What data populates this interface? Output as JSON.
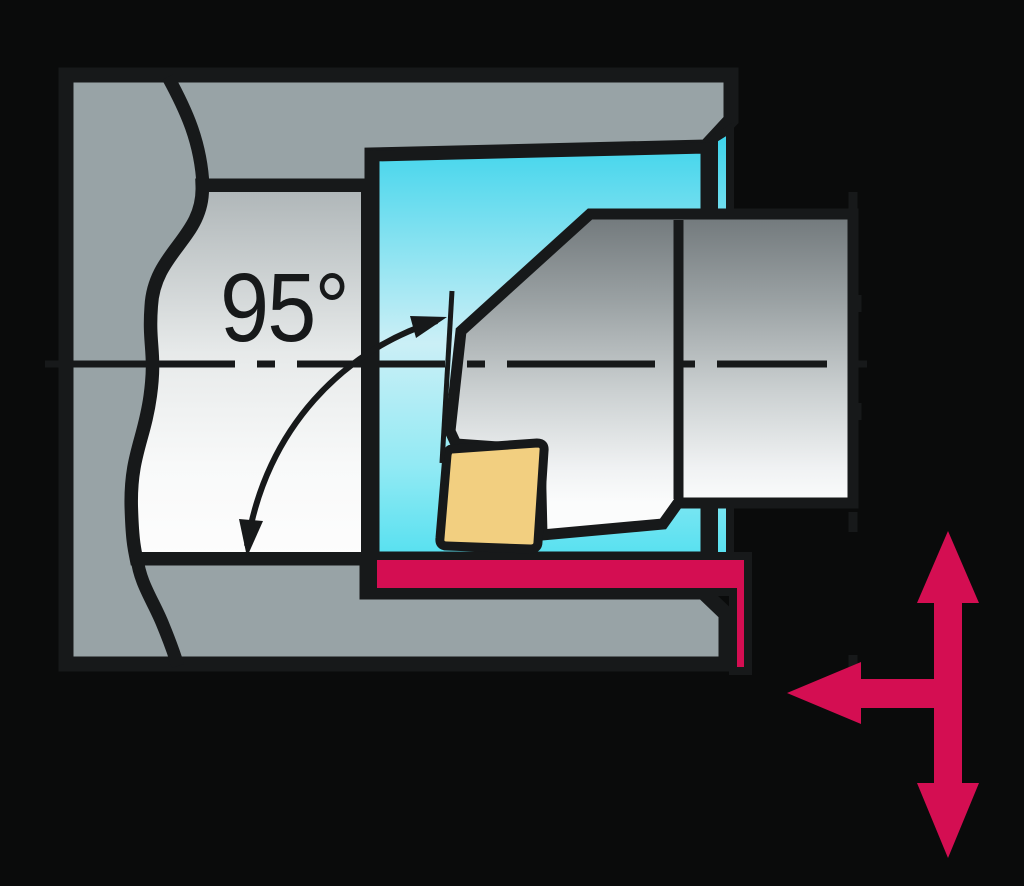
{
  "figure": {
    "type": "technical-diagram",
    "subject": "internal boring tool in workpiece cross-section",
    "angle_label": "95°",
    "colors": {
      "background": "#0a0b0b",
      "line": "#17191a",
      "workpiece_gray": "#98a3a6",
      "bore_surface_light": "#f6f7f7",
      "bore_cavity_cyan": "#3fd5ec",
      "machined_red": "#d40e52",
      "insert_yellow": "#f2cf80",
      "tool_gray_dark": "#71787b",
      "tool_gray_light": "#fbfcfc"
    },
    "icons": {
      "feed_arrow_vertical": "double-headed-arrow-vertical",
      "feed_arrow_horizontal": "arrow-left"
    }
  }
}
